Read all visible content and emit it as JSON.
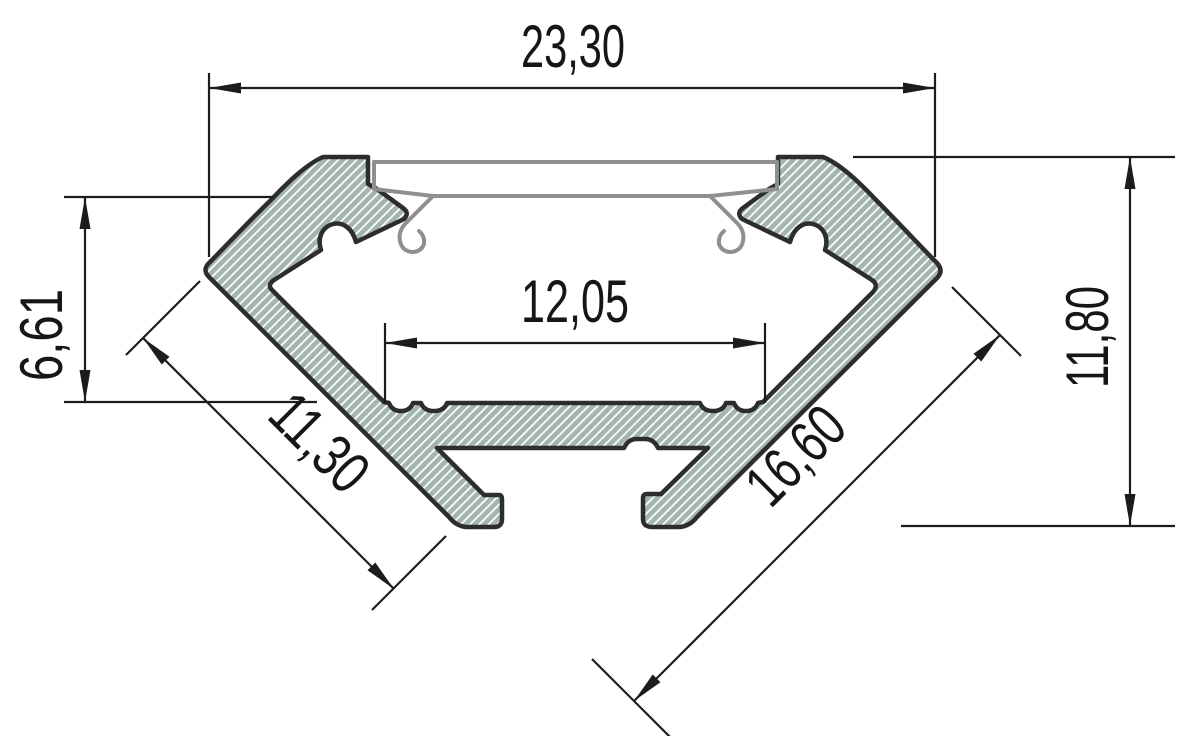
{
  "drawing": {
    "labels": {
      "width_top": "23,30",
      "channel_width": "12,05",
      "channel_depth": "6,61",
      "total_height": "11,80",
      "left_side": "11,30",
      "right_side": "16,60"
    },
    "colors": {
      "background": "#ffffff",
      "profile_outline": "#2d2d2d",
      "profile_hatch_fill": "#a4b5b0",
      "profile_hatch_lines": "#ffffff",
      "dimension_lines": "#1c1c1c",
      "cover_outline": "#8f8f8f"
    }
  }
}
